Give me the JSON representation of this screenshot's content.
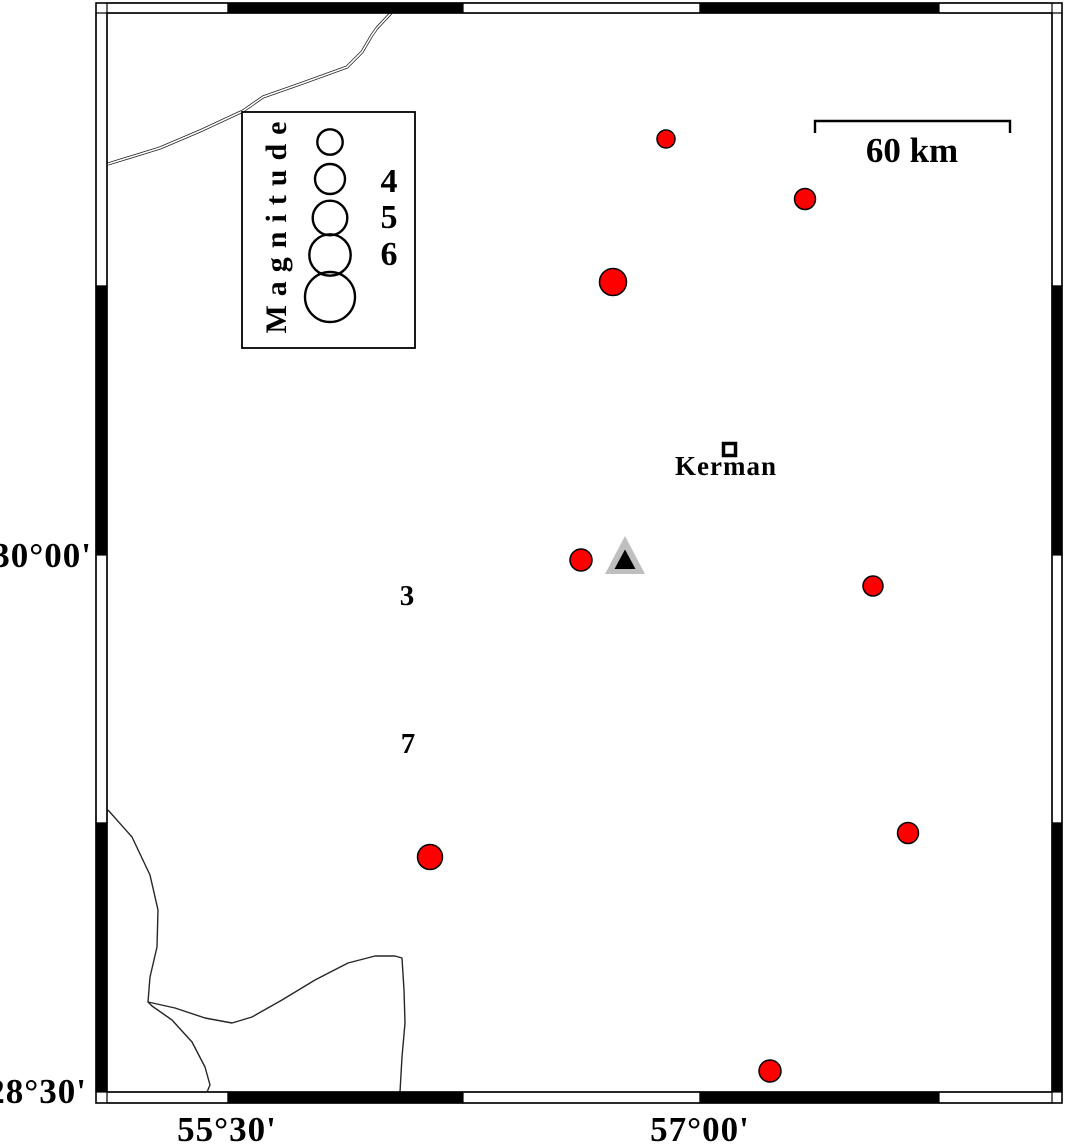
{
  "figure": {
    "width": 1066,
    "height": 1145,
    "background": "#ffffff"
  },
  "colors": {
    "epicenter_fill": "#ff0000",
    "marker_stroke": "#000000",
    "triangle_outer_fill": "#bfbfbf",
    "triangle_inner_fill": "#000000",
    "frame_black": "#000000",
    "frame_white": "#ffffff",
    "boundary_line": "#262626"
  },
  "frame": {
    "outer": {
      "x1": 96,
      "y1": 3,
      "x2": 1062,
      "y2": 1103
    },
    "inner": {
      "x1": 107,
      "y1": 13,
      "x2": 1052,
      "y2": 1092
    },
    "h_boundaries": [
      228,
      463,
      700,
      939
    ],
    "v_boundaries": [
      286,
      555,
      823
    ]
  },
  "axis_labels": {
    "left": [
      {
        "text": "30°00'",
        "x": 92,
        "y": 567
      },
      {
        "text": "28°30'",
        "x": 87,
        "y": 1103
      }
    ],
    "bottom": [
      {
        "text": "55°30'",
        "x": 227,
        "y": 1141
      },
      {
        "text": "57°00'",
        "x": 700,
        "y": 1141
      }
    ]
  },
  "scale_bar": {
    "label": "60 km",
    "x1": 815,
    "x2": 1010,
    "bar_y": 121,
    "tick_y": 133,
    "label_x": 912,
    "label_y": 162
  },
  "legend": {
    "title": "Magnitude",
    "box": {
      "x": 242,
      "y": 112,
      "w": 173,
      "h": 236
    },
    "title_cx": 286,
    "title_cy": 223,
    "circles": [
      {
        "cx": 330,
        "cy": 142,
        "r": 12.7
      },
      {
        "cx": 330,
        "cy": 179,
        "r": 15
      },
      {
        "cx": 330,
        "cy": 218,
        "r": 17.3
      },
      {
        "cx": 330,
        "cy": 255,
        "r": 20.7
      },
      {
        "cx": 330,
        "cy": 297,
        "r": 25
      }
    ],
    "labels": [
      {
        "text": "4",
        "x": 389,
        "y": 192
      },
      {
        "text": "5",
        "x": 389,
        "y": 228
      },
      {
        "text": "6",
        "x": 389,
        "y": 265
      }
    ]
  },
  "city": {
    "label": "Kerman",
    "square": {
      "x": 723.5,
      "y": 443.5,
      "size": 12
    },
    "label_x": 726,
    "label_y": 475
  },
  "station_triangle": {
    "outer_points": "625,536 605,574 645,574",
    "inner_points": "625,549.5 614.5,569 635.5,569"
  },
  "zone_labels": [
    {
      "text": "3",
      "x": 407,
      "y": 605
    },
    {
      "text": "7",
      "x": 408,
      "y": 753
    }
  ],
  "epicenters": [
    {
      "cx": 666,
      "cy": 139,
      "r": 9
    },
    {
      "cx": 805,
      "cy": 199,
      "r": 10.5
    },
    {
      "cx": 613,
      "cy": 282,
      "r": 13.5
    },
    {
      "cx": 581,
      "cy": 560,
      "r": 11
    },
    {
      "cx": 873,
      "cy": 586,
      "r": 10
    },
    {
      "cx": 430,
      "cy": 857,
      "r": 12.5
    },
    {
      "cx": 908,
      "cy": 833,
      "r": 10.5
    },
    {
      "cx": 770,
      "cy": 1071,
      "r": 11
    }
  ],
  "boundary_lines": {
    "double_line_nw": [
      [
        108,
        164
      ],
      [
        160,
        148
      ],
      [
        200,
        131
      ],
      [
        243,
        111
      ],
      [
        263,
        97
      ],
      [
        300,
        84
      ],
      [
        347,
        67
      ],
      [
        362,
        52
      ],
      [
        372,
        35
      ],
      [
        377,
        28
      ],
      [
        391,
        13
      ]
    ],
    "line_sw_main": [
      [
        108,
        810
      ],
      [
        132,
        837
      ],
      [
        150,
        875
      ],
      [
        158,
        910
      ],
      [
        157,
        947
      ],
      [
        150,
        977
      ],
      [
        148,
        1002
      ],
      [
        152,
        1006
      ],
      [
        172,
        1020
      ],
      [
        192,
        1042
      ],
      [
        205,
        1067
      ],
      [
        210,
        1085
      ],
      [
        207,
        1092
      ]
    ],
    "line_sw_branch": [
      [
        148,
        1002
      ],
      [
        175,
        1008
      ],
      [
        205,
        1018
      ],
      [
        232,
        1023
      ],
      [
        252,
        1017
      ],
      [
        282,
        1000
      ],
      [
        315,
        980
      ],
      [
        348,
        963
      ],
      [
        375,
        956
      ],
      [
        395,
        956
      ],
      [
        402,
        958
      ],
      [
        404,
        990
      ],
      [
        405,
        1023
      ],
      [
        402,
        1057
      ],
      [
        400,
        1092
      ]
    ]
  }
}
